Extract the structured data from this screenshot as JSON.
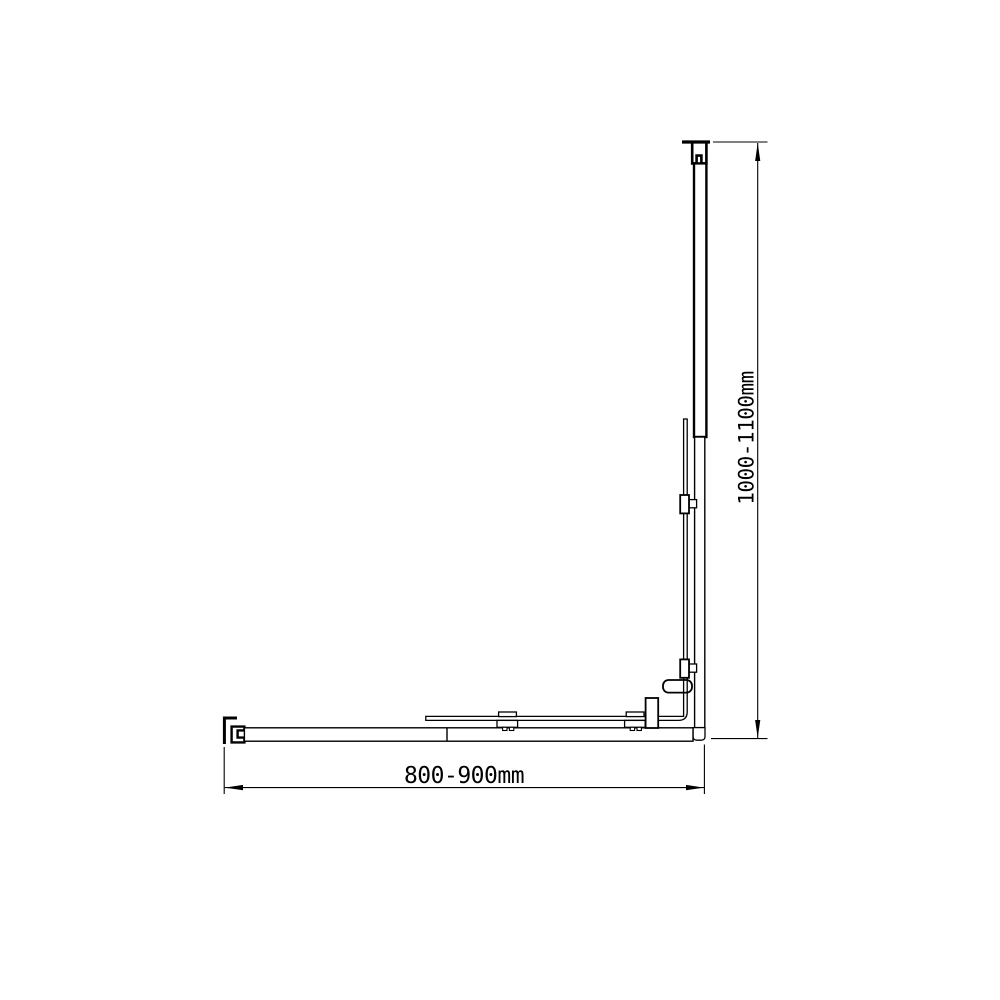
{
  "canvas": {
    "background": "#ffffff",
    "line_color": "#000000"
  },
  "dimension_labels": {
    "width": "800-900mm",
    "height": "1000-1100mm"
  }
}
